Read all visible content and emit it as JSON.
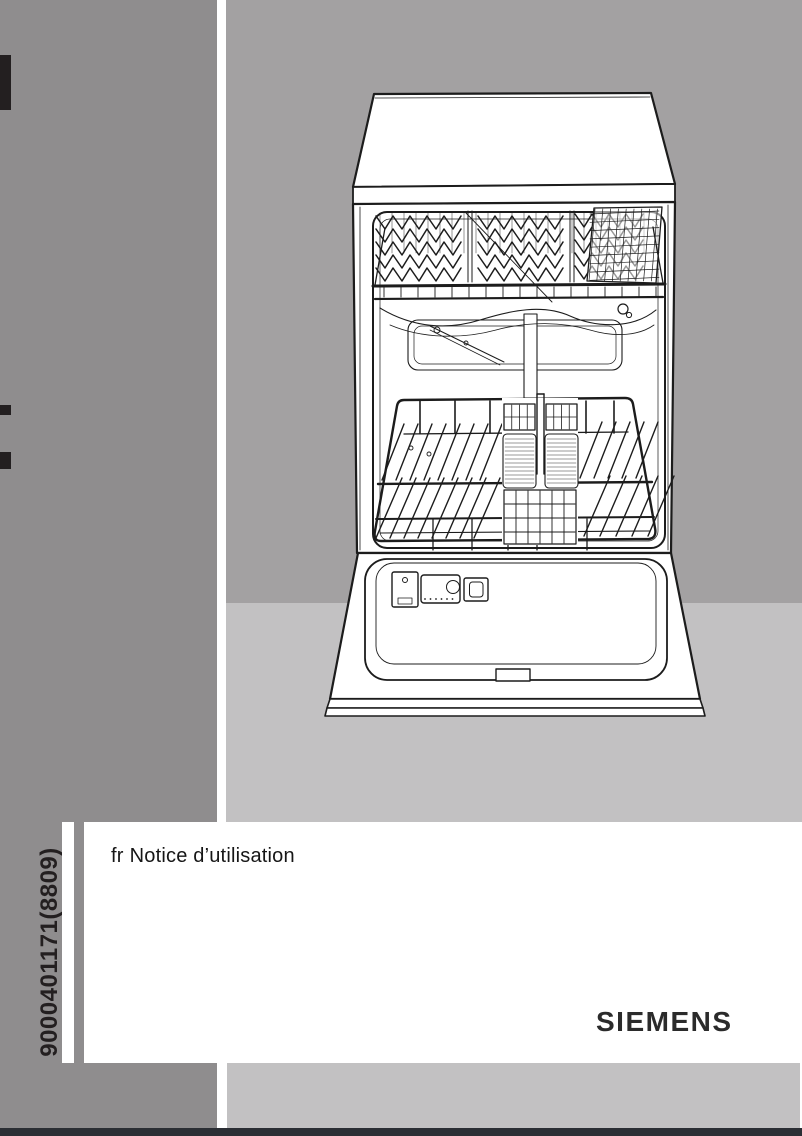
{
  "cover": {
    "language_code": "fr",
    "title": "Notice d’utilisation",
    "order_number": "9000401171(8809)",
    "brand": "SIEMENS"
  },
  "illustration": {
    "name": "dishwasher-open-front",
    "description": "Line drawing of an open dishwasher with upper rack, lower rack and cutlery basket"
  },
  "colors": {
    "column_gray": "#8f8d8e",
    "wall_gray": "#a3a1a2",
    "floor_gray": "#c2c1c2",
    "footer_band": "#2b2e34",
    "mark_black": "#231f20",
    "ink": "#1c1c1c"
  }
}
